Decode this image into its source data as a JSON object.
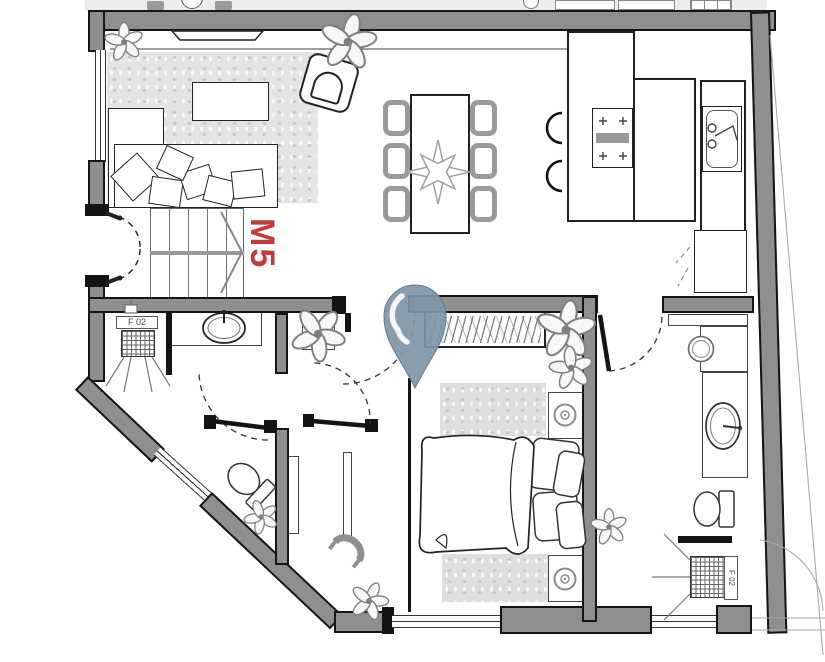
{
  "plan": {
    "unit_label": "M5",
    "fixture_labels": {
      "shower_left": "F 02",
      "shower_right": "F 02"
    },
    "icons": {
      "pin_icon": "location-marker",
      "stairs_icon": "staircase-up-arrow",
      "plant_icon": "potted-plant"
    },
    "colors": {
      "wall": "#8f8f8f",
      "wall_outline": "#151515",
      "label_red": "#c23b3b",
      "pin_blue": "#7e95a7",
      "rug": "#e4e4e4",
      "line": "#333333",
      "lgray": "#9a9a9a"
    }
  }
}
